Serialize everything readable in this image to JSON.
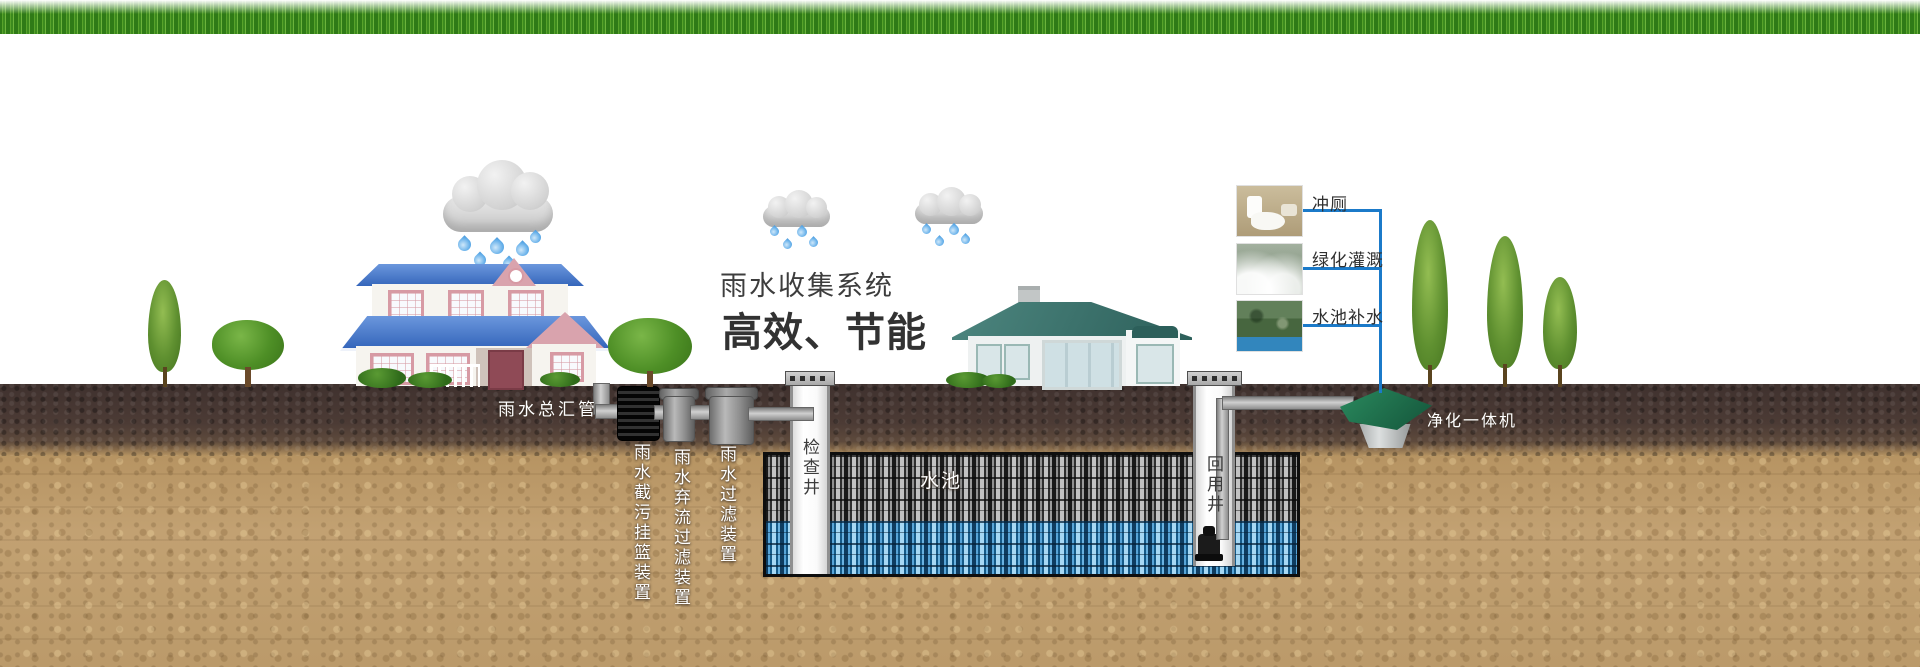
{
  "title": {
    "line1": "雨水收集系统",
    "line2": "高效、节能"
  },
  "labels": {
    "main_pipe": "雨水总汇管",
    "intercept_basket_device": "雨水截污挂篮装置",
    "diversion_filter_device": "雨水弃流过滤装置",
    "filter_device": "雨水过滤装置",
    "inspection_well": "检查井",
    "storage_tank": "水池",
    "reuse_well": "回用井",
    "purifier_unit": "净化一体机"
  },
  "reuse_outputs": [
    {
      "label": "冲厕"
    },
    {
      "label": "绿化灌溉"
    },
    {
      "label": "水池补水"
    }
  ],
  "colors": {
    "connector_blue": "#1b7ac9",
    "title_text": "#3a3a3a",
    "water_module_blue": "#5aa7d8",
    "grass_green": "#4f9427",
    "left_roof_blue": "#3a68bd",
    "right_roof_teal": "#2f6862",
    "purifier_green": "#1d6e4e",
    "soil_dark": "#4a3a36",
    "soil_light": "#bfa06f"
  }
}
